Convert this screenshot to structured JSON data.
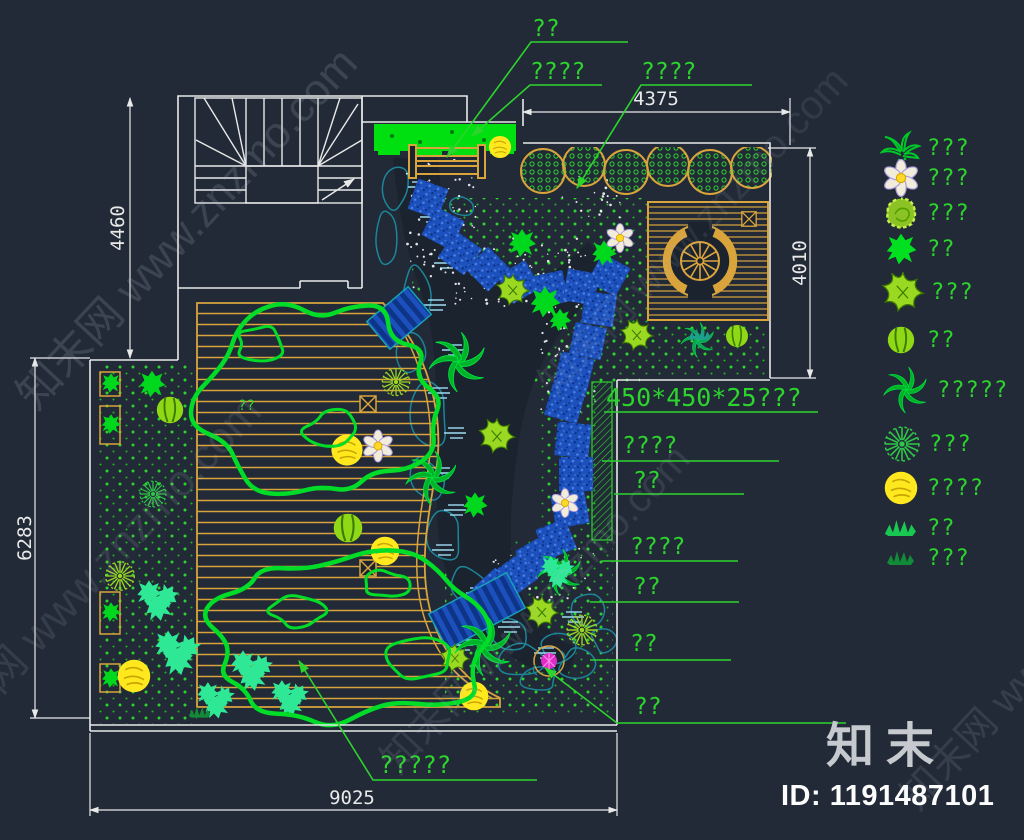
{
  "plan": {
    "dims": {
      "top": "4375",
      "right": "4010",
      "left_upper": "4460",
      "left_lower": "6283",
      "bottom": "9025"
    },
    "callouts": {
      "bench": "??",
      "hedge": "????",
      "shrub_row": "????",
      "paving_spec": "450*450*25???",
      "right": [
        "????",
        "??",
        "????",
        "??",
        "??",
        "??"
      ],
      "bottom": "?????",
      "deck": "??"
    }
  },
  "legend": {
    "items": [
      {
        "icon": "palm-plant-icon",
        "label": "???"
      },
      {
        "icon": "white-flower-icon",
        "label": "???"
      },
      {
        "icon": "round-shrub-icon",
        "label": "???"
      },
      {
        "icon": "small-shrub-icon",
        "label": "??"
      },
      {
        "icon": "star-lily-icon",
        "label": "???"
      },
      {
        "icon": "ball-plant-icon",
        "label": "??"
      },
      {
        "icon": "large-leaf-plant-icon",
        "label": "?????"
      },
      {
        "icon": "dandelion-tree-icon",
        "label": "???"
      },
      {
        "icon": "yellow-tree-icon",
        "label": "????"
      },
      {
        "icon": "grass-clump-icon",
        "label": "??"
      },
      {
        "icon": "dark-grass-icon",
        "label": "???"
      }
    ]
  },
  "watermark": {
    "diag": "知末网 www.znzmo.com",
    "logo": "知末",
    "id_text": "ID: 1191487101"
  },
  "colors": {
    "background": "#212a36",
    "cad_green": "#2dd42d",
    "canopy_green": "#00dc28",
    "wood_orange": "#d9a43c",
    "stone_blue": "#1c50bc",
    "rock_teal": "#1d8598",
    "dim_white": "#e9e9e9",
    "tree_yellow": "#ffe81e",
    "tree_chartreuse": "#9ad822"
  }
}
